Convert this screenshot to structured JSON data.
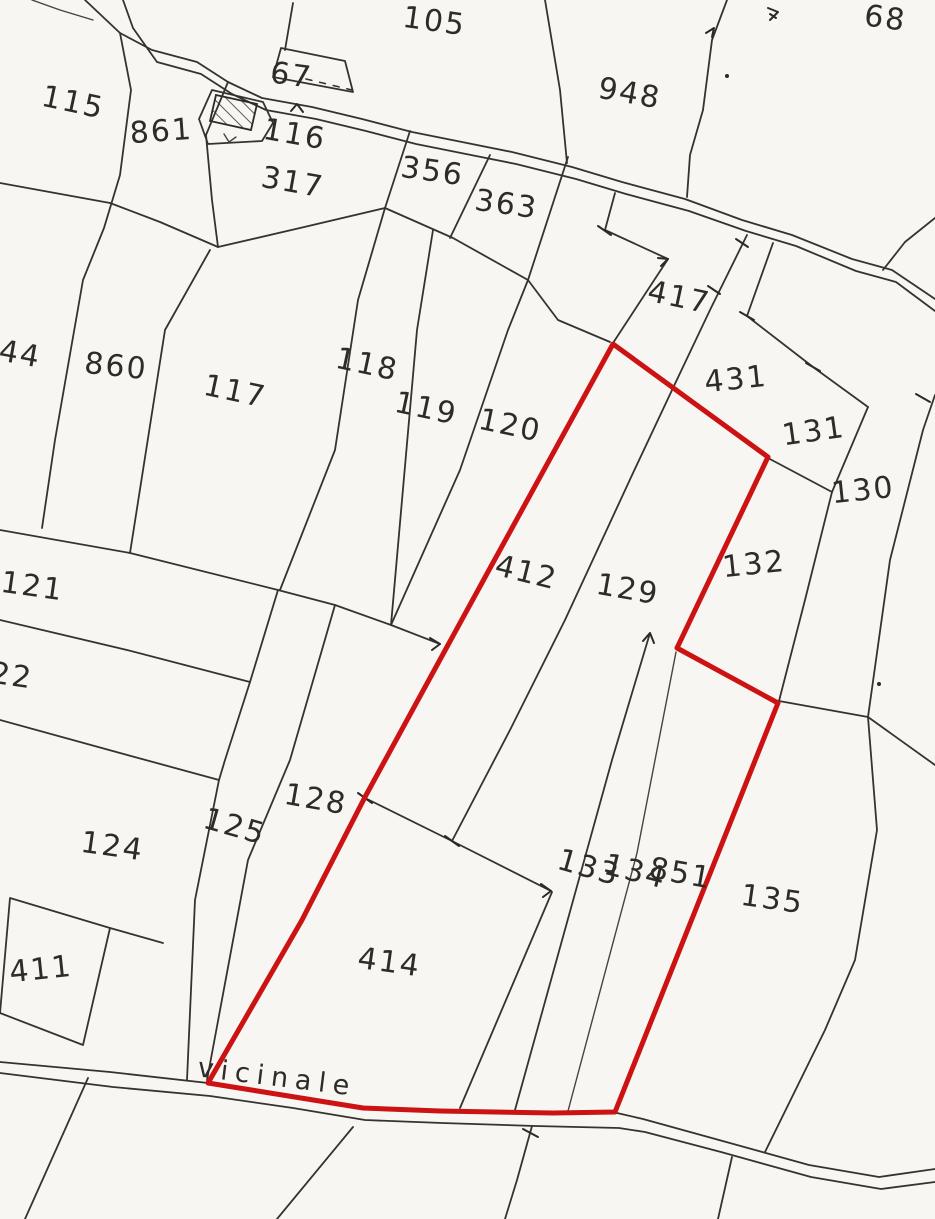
{
  "map": {
    "type": "cadastral-plan",
    "paper_color": "#f7f6f2",
    "line_color": "#35332e",
    "highlight_color": "#cc1212",
    "road_label": {
      "text": "vicinale",
      "x": 276,
      "y": 1086,
      "rot": 7
    },
    "highlighted_parcel_outline": [
      [
        613,
        344
      ],
      [
        768,
        457
      ],
      [
        677,
        648
      ],
      [
        778,
        703
      ],
      [
        615,
        1112
      ],
      [
        553,
        1113
      ],
      [
        440,
        1111
      ],
      [
        363,
        1108
      ],
      [
        208,
        1083
      ],
      [
        302,
        920
      ],
      [
        365,
        797
      ],
      [
        448,
        645
      ],
      [
        489,
        570
      ],
      [
        613,
        344
      ]
    ],
    "parcel_labels": [
      {
        "text": "105",
        "x": 433,
        "y": 20,
        "rot": 8
      },
      {
        "text": "68",
        "x": 884,
        "y": 17,
        "rot": 8
      },
      {
        "text": "115",
        "x": 71,
        "y": 101,
        "rot": 12
      },
      {
        "text": "861",
        "x": 162,
        "y": 130,
        "rot": -4
      },
      {
        "text": "67",
        "x": 290,
        "y": 74,
        "rot": 8
      },
      {
        "text": "116",
        "x": 293,
        "y": 133,
        "rot": 10
      },
      {
        "text": "317",
        "x": 291,
        "y": 181,
        "rot": 10
      },
      {
        "text": "356",
        "x": 431,
        "y": 170,
        "rot": 8
      },
      {
        "text": "363",
        "x": 505,
        "y": 203,
        "rot": 8
      },
      {
        "text": "948",
        "x": 628,
        "y": 92,
        "rot": 10
      },
      {
        "text": "417",
        "x": 677,
        "y": 296,
        "rot": 12
      },
      {
        "text": "431",
        "x": 737,
        "y": 378,
        "rot": -6
      },
      {
        "text": "131",
        "x": 815,
        "y": 430,
        "rot": -8
      },
      {
        "text": "130",
        "x": 864,
        "y": 489,
        "rot": -6
      },
      {
        "text": "144",
        "x": 8,
        "y": 351,
        "rot": 10
      },
      {
        "text": "860",
        "x": 115,
        "y": 365,
        "rot": 6
      },
      {
        "text": "117",
        "x": 233,
        "y": 390,
        "rot": 12
      },
      {
        "text": "118",
        "x": 365,
        "y": 363,
        "rot": 12
      },
      {
        "text": "119",
        "x": 424,
        "y": 407,
        "rot": 12
      },
      {
        "text": "120",
        "x": 508,
        "y": 424,
        "rot": 12
      },
      {
        "text": "412",
        "x": 524,
        "y": 571,
        "rot": 14
      },
      {
        "text": "129",
        "x": 626,
        "y": 588,
        "rot": 10
      },
      {
        "text": "132",
        "x": 755,
        "y": 563,
        "rot": -6
      },
      {
        "text": "121",
        "x": 31,
        "y": 585,
        "rot": 8
      },
      {
        "text": "122",
        "x": 0,
        "y": 673,
        "rot": 8
      },
      {
        "text": "124",
        "x": 111,
        "y": 845,
        "rot": 8
      },
      {
        "text": "125",
        "x": 232,
        "y": 825,
        "rot": 16
      },
      {
        "text": "128",
        "x": 314,
        "y": 798,
        "rot": 10
      },
      {
        "text": "411",
        "x": 42,
        "y": 968,
        "rot": -6
      },
      {
        "text": "414",
        "x": 388,
        "y": 961,
        "rot": 8
      },
      {
        "text": "133",
        "x": 586,
        "y": 866,
        "rot": 16
      },
      {
        "text": "134",
        "x": 633,
        "y": 870,
        "rot": 14
      },
      {
        "text": "851",
        "x": 679,
        "y": 872,
        "rot": 10
      },
      {
        "text": "135",
        "x": 771,
        "y": 898,
        "rot": 8
      }
    ]
  }
}
